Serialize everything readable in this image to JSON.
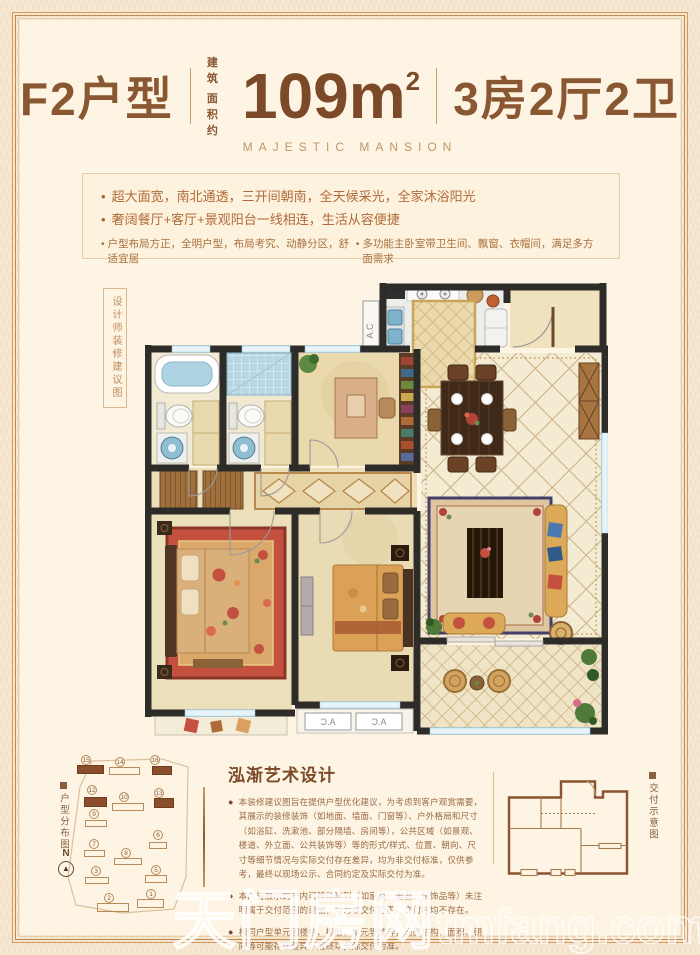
{
  "header": {
    "unit_label": "F2户型",
    "area_prefix_line1": "建 筑",
    "area_prefix_line2": "面积约",
    "area_value": "109m",
    "area_sup": "2",
    "rooms_label": "3房2厅2卫",
    "subtitle": "MAJESTIC  MANSION"
  },
  "features": {
    "large": [
      "超大面宽，南北通透，三开间朝南，全天候采光，全家沐浴阳光",
      "奢阔餐厅+客厅+景观阳台一线相连，生活从容便捷"
    ],
    "small": [
      "户型布局方正，全明户型，布局考究、动静分区，舒适宜居",
      "多功能主卧室带卫生间、飘窗、衣帽间，满足多方面需求"
    ]
  },
  "floorplan": {
    "side_label": "设计师装修建议图",
    "ac_label": "A.C"
  },
  "bottom": {
    "site_plan": {
      "label": "户型分布图",
      "compass": "N",
      "buildings": [
        {
          "no": "15",
          "hl": true,
          "bx": 15,
          "by": 8,
          "bw": 27,
          "bh": 9,
          "nx": 24,
          "ny": 3
        },
        {
          "no": "14",
          "hl": false,
          "bx": 47,
          "by": 10,
          "bw": 31,
          "bh": 8,
          "nx": 58,
          "ny": 5
        },
        {
          "no": "16",
          "hl": true,
          "bx": 90,
          "by": 9,
          "bw": 20,
          "bh": 9,
          "nx": 93,
          "ny": 3
        },
        {
          "no": "12",
          "hl": true,
          "bx": 22,
          "by": 40,
          "bw": 23,
          "bh": 10,
          "nx": 30,
          "ny": 33
        },
        {
          "no": "10",
          "hl": false,
          "bx": 50,
          "by": 46,
          "bw": 32,
          "bh": 8,
          "nx": 62,
          "ny": 40
        },
        {
          "no": "13",
          "hl": true,
          "bx": 92,
          "by": 41,
          "bw": 20,
          "bh": 10,
          "nx": 97,
          "ny": 36
        },
        {
          "no": "9",
          "hl": false,
          "bx": 23,
          "by": 63,
          "bw": 22,
          "bh": 7,
          "nx": 32,
          "ny": 57
        },
        {
          "no": "6",
          "hl": false,
          "bx": 87,
          "by": 85,
          "bw": 18,
          "bh": 7,
          "nx": 96,
          "ny": 78
        },
        {
          "no": "7",
          "hl": false,
          "bx": 22,
          "by": 93,
          "bw": 21,
          "bh": 7,
          "nx": 32,
          "ny": 87
        },
        {
          "no": "8",
          "hl": false,
          "bx": 52,
          "by": 101,
          "bw": 28,
          "bh": 7,
          "nx": 64,
          "ny": 96
        },
        {
          "no": "3",
          "hl": false,
          "bx": 23,
          "by": 120,
          "bw": 24,
          "bh": 7,
          "nx": 34,
          "ny": 114
        },
        {
          "no": "5",
          "hl": false,
          "bx": 83,
          "by": 118,
          "bw": 22,
          "bh": 8,
          "nx": 94,
          "ny": 113
        },
        {
          "no": "2",
          "hl": false,
          "bx": 35,
          "by": 146,
          "bw": 32,
          "bh": 9,
          "nx": 47,
          "ny": 141
        },
        {
          "no": "1",
          "hl": false,
          "bx": 75,
          "by": 142,
          "bw": 27,
          "bh": 9,
          "nx": 89,
          "ny": 137
        }
      ]
    },
    "design_title": "泓渐艺术设计",
    "disclaimers": [
      "本装修建议图旨在提供户型优化建议，为考虑到客户观赏需要，其展示的装修装饰（如地面、墙面、门窗等）、户外格局和尺寸（如浴缸、洗漱池、部分隔墙、房间等），公共区域（如景观、楼道、外立面、公共装饰等）等的形式/样式、位置、朝向、尺寸等细节情况与实际交付存在差异，均为非交付标准，仅供参考，最终以现场公示、合同约定及实际交付为准。",
      "本广告展示的户内可移动陈列（如家具、电器、装饰品等）未注明属于交付范围的设施，均为非交付范围，交付时均不存在。",
      "相同户型单元因楼栋、楼层、单元等差异，局部结构、面积、朝向等可能存在差异，最终以实际交付为准。"
    ],
    "delivery_label": "交付示意图",
    "watermark_cjk": "天门房网",
    "watermark_latin": "tmfang.com"
  },
  "colors": {
    "accent_brown": "#8a5733",
    "wall_dark": "#2e2c29",
    "building_highlight": "#8a4f2a",
    "window_blue": "#d6ecf5"
  }
}
